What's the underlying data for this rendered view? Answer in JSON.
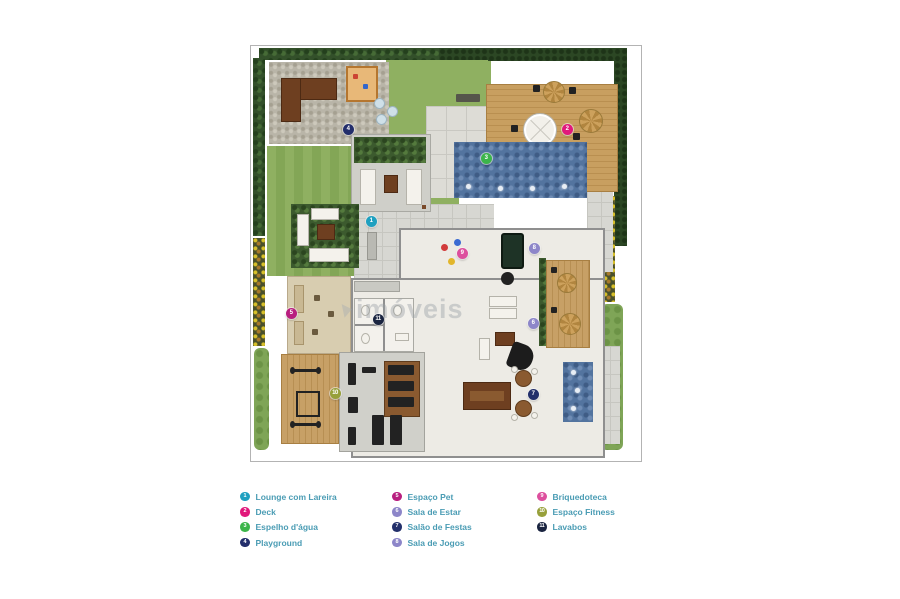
{
  "watermark": {
    "text": "imóveis"
  },
  "legend": {
    "columns": [
      [
        {
          "n": "1",
          "label": "Lounge com Lareira",
          "color": "#1fa0c0"
        },
        {
          "n": "2",
          "label": "Deck",
          "color": "#e1187b"
        },
        {
          "n": "3",
          "label": "Espelho d'água",
          "color": "#3cb54a"
        },
        {
          "n": "4",
          "label": "Playground",
          "color": "#232e6b"
        }
      ],
      [
        {
          "n": "5",
          "label": "Espaço Pet",
          "color": "#b81e7f"
        },
        {
          "n": "6",
          "label": "Sala de Estar",
          "color": "#8d86c9"
        },
        {
          "n": "7",
          "label": "Salão de Festas",
          "color": "#23306b"
        },
        {
          "n": "8",
          "label": "Sala de Jogos",
          "color": "#8d86c9"
        }
      ],
      [
        {
          "n": "9",
          "label": "Briquedoteca",
          "color": "#dd4f9e"
        },
        {
          "n": "10",
          "label": "Espaço Fitness",
          "color": "#97a03b"
        },
        {
          "n": "11",
          "label": "Lavabos",
          "color": "#1a2440"
        }
      ]
    ]
  },
  "plan": {
    "markers": [
      {
        "n": "1",
        "x": 120,
        "y": 175,
        "color": "#1fa0c0"
      },
      {
        "n": "2",
        "x": 316,
        "y": 83,
        "color": "#e1187b"
      },
      {
        "n": "3",
        "x": 235,
        "y": 112,
        "color": "#3cb54a"
      },
      {
        "n": "4",
        "x": 97,
        "y": 83,
        "color": "#232e6b"
      },
      {
        "n": "5",
        "x": 40,
        "y": 267,
        "color": "#b81e7f"
      },
      {
        "n": "6",
        "x": 282,
        "y": 277,
        "color": "#8d86c9"
      },
      {
        "n": "7",
        "x": 282,
        "y": 348,
        "color": "#23306b"
      },
      {
        "n": "8",
        "x": 283,
        "y": 202,
        "color": "#8d86c9"
      },
      {
        "n": "9",
        "x": 211,
        "y": 207,
        "color": "#dd4f9e"
      },
      {
        "n": "10",
        "x": 84,
        "y": 347,
        "color": "#97a03b"
      },
      {
        "n": "11",
        "x": 127,
        "y": 273,
        "color": "#1a2440"
      }
    ]
  }
}
